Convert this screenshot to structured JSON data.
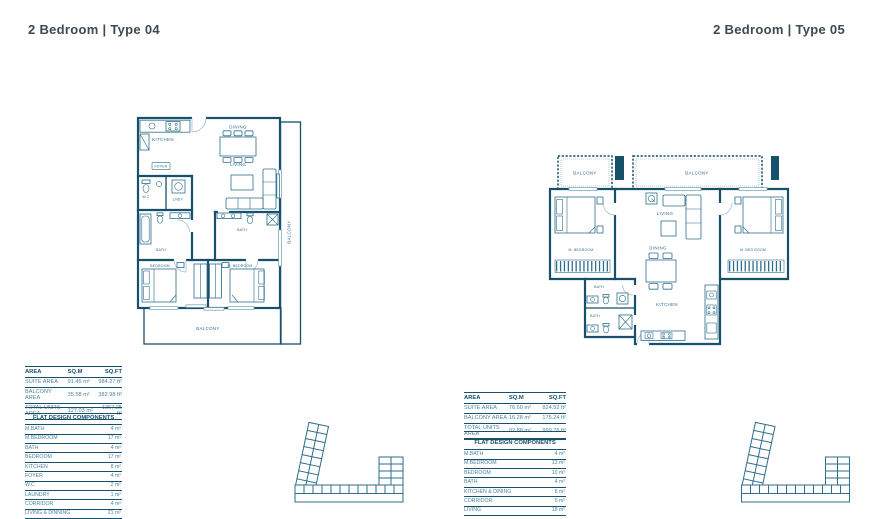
{
  "colors": {
    "primary": "#16506B",
    "line_medium": "#2E6E8E",
    "text_teal": "#4E84A0",
    "highlight": "#B9D3E4",
    "title_text": "#3E4A52",
    "background": "#FFFFFF"
  },
  "type04": {
    "title": "2 Bedroom | Type 04",
    "plan": {
      "kitchen": "KITCHEN",
      "dining": "DINING",
      "living": "LIVING",
      "wc": "W.C",
      "laundry": "LNDY",
      "foyer": "FOYER",
      "bath": "BATH",
      "master_bath": "BATH",
      "bedroom": "BEDROOM",
      "master_bedroom": "M. BEDROOM",
      "balcony_bottom": "BALCONY",
      "balcony_right": "BALCONY"
    },
    "area_table": {
      "headers": [
        "AREA",
        "SQ.M",
        "SQ.FT"
      ],
      "rows": [
        {
          "label": "SUITE AREA",
          "sqm": "91.45 m²",
          "sqft": "984.27 ft²"
        },
        {
          "label": "BALCONY AREA",
          "sqm": "35.58 m²",
          "sqft": "382.98 ft²"
        },
        {
          "label": "TOTAL UNITS AREA",
          "sqm": "127.03 m²",
          "sqft": "1367.25 ft²"
        }
      ]
    },
    "components_table": {
      "title": "FLAT DESIGN COMPONENTS",
      "rows": [
        {
          "label": "M.BATH",
          "value": "4 m²"
        },
        {
          "label": "M.BEDROOM",
          "value": "17 m²"
        },
        {
          "label": "BATH",
          "value": "4 m²"
        },
        {
          "label": "BEDROOM",
          "value": "17 m²"
        },
        {
          "label": "KITCHEN",
          "value": "8 m²"
        },
        {
          "label": "FOYER",
          "value": "4 m²"
        },
        {
          "label": "W.C",
          "value": "2 m²"
        },
        {
          "label": "LAUNDRY",
          "value": "1 m²"
        },
        {
          "label": "CORRIDOR",
          "value": "4 m²"
        },
        {
          "label": "LIVING & DINNING",
          "value": "21 m²"
        }
      ]
    },
    "key_plan": {
      "highlighted_unit_position": "bottom-right"
    }
  },
  "type05": {
    "title": "2 Bedroom | Type 05",
    "plan": {
      "balcony_left": "BALCONY",
      "balcony_right": "BALCONY",
      "master_bedroom_left": "M. BEDROOM",
      "master_bedroom_right": "M. BED ROOM",
      "living": "LIVING",
      "dining": "DINING",
      "kitchen": "KITCHEN",
      "bath_upper": "BATH",
      "bath_lower": "BATH"
    },
    "area_table": {
      "headers": [
        "AREA",
        "SQ.M",
        "SQ.FT"
      ],
      "rows": [
        {
          "label": "SUITE AREA",
          "sqm": "76.60 m²",
          "sqft": "824.52 ft²"
        },
        {
          "label": "BALCONY AREA",
          "sqm": "16.28 m²",
          "sqft": "175.24 ft²"
        },
        {
          "label": "TOTAL UNITS AREA",
          "sqm": "92.88 m²",
          "sqft": "999.76 ft²"
        }
      ]
    },
    "components_table": {
      "title": "FLAT DESIGN COMPONENTS",
      "rows": [
        {
          "label": "M.BATH",
          "value": "4 m²"
        },
        {
          "label": "M.BEDROOM",
          "value": "13 m²"
        },
        {
          "label": "BEDROOM",
          "value": "10 m²"
        },
        {
          "label": "BATH",
          "value": "4 m²"
        },
        {
          "label": "KITCHEN & DINING",
          "value": "8 m²"
        },
        {
          "label": "CORRIDOR",
          "value": "5 m²"
        },
        {
          "label": "LIVING",
          "value": "18 m²"
        }
      ]
    },
    "key_plan": {
      "highlighted_unit_position": "bottom-center"
    }
  }
}
